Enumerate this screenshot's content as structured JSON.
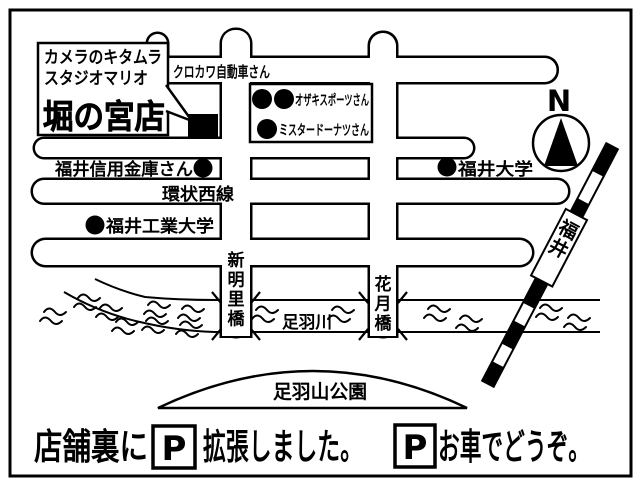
{
  "colors": {
    "ink": "#000000",
    "paper": "#ffffff"
  },
  "callout": {
    "line1": "カメラのキタムラ",
    "line2": "スタジオマリオ",
    "store_name": "堀の宮店"
  },
  "compass": {
    "north_label": "N"
  },
  "landmarks": {
    "kurokawa_auto": "クロカワ自動車さん",
    "ozaki_sports": "オザキスポーツさん",
    "mister_donut": "ミスタードーナツさん",
    "fukui_shinkin_bank": "福井信用金庫さん",
    "fukui_university": "福井大学",
    "fukui_tech_university": "福井工業大学",
    "asuwayama_park": "足羽山公園"
  },
  "roads": {
    "ring_west_line": "環状西線"
  },
  "river": {
    "name": "足羽川"
  },
  "bridges": {
    "shin_akari": "新明里橋",
    "kagetsu": "花月橋"
  },
  "railway": {
    "destination": "福井"
  },
  "footer": {
    "prefix": "店舗裏に",
    "parking_symbol": "P",
    "suffix": "拡張しました。",
    "car_note": "お車でどうぞ。"
  }
}
